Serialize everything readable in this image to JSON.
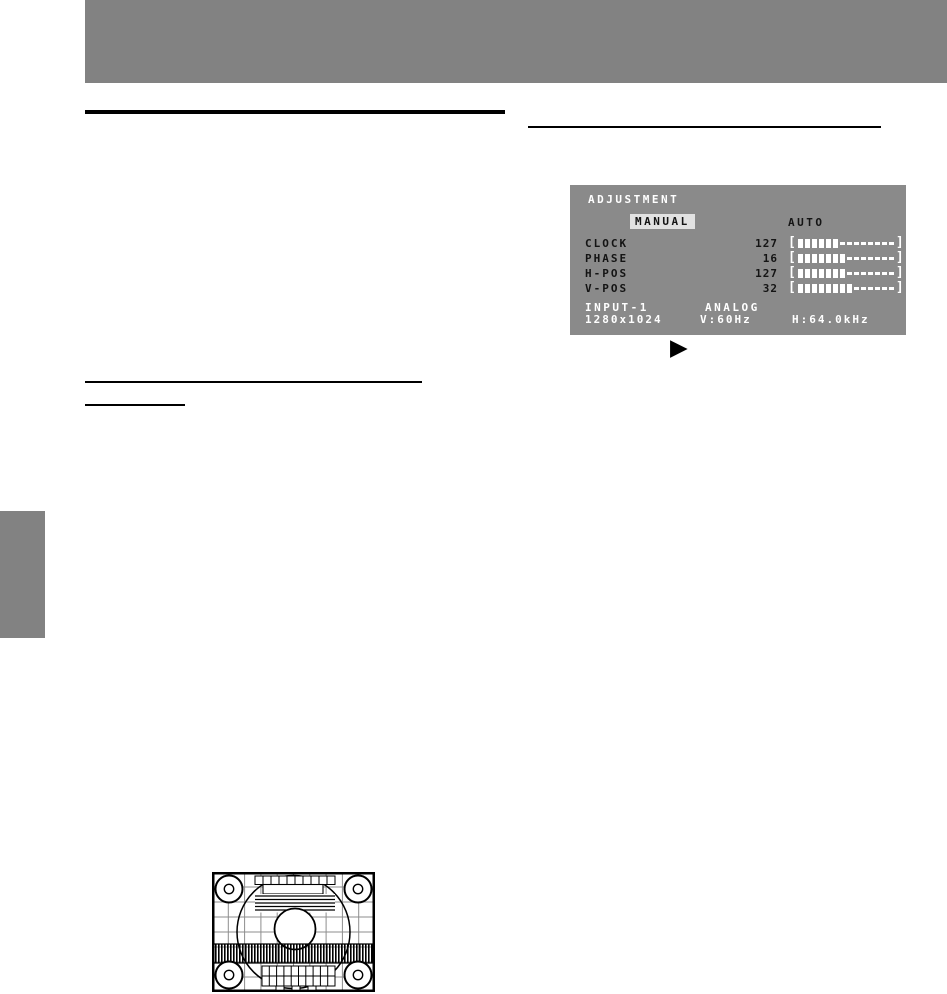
{
  "colors": {
    "page_bg": "#ffffff",
    "band_gray": "#828282",
    "osd_bg": "#8a8a8a",
    "osd_text_light": "#ffffff",
    "osd_text_dark": "#141414",
    "highlight_bg": "#e2e2e2",
    "rule_black": "#000000"
  },
  "osd": {
    "title": "ADJUSTMENT",
    "selected_mode": "MANUAL",
    "auto_option": "AUTO",
    "bar_open": "[",
    "bar_close": "]",
    "rows": [
      {
        "label": "CLOCK",
        "value": "127",
        "filled": 6,
        "total": 14
      },
      {
        "label": "PHASE",
        "value": "16",
        "filled": 7,
        "total": 14
      },
      {
        "label": "H-POS",
        "value": "127",
        "filled": 7,
        "total": 14
      },
      {
        "label": "V-POS",
        "value": "32",
        "filled": 8,
        "total": 14
      }
    ],
    "input": "INPUT-1",
    "signal": "ANALOG",
    "resolution": "1280x1024",
    "v_sync": "V:60Hz",
    "h_sync": "H:64.0kHz"
  },
  "icons": {
    "next_arrow": "▶"
  }
}
